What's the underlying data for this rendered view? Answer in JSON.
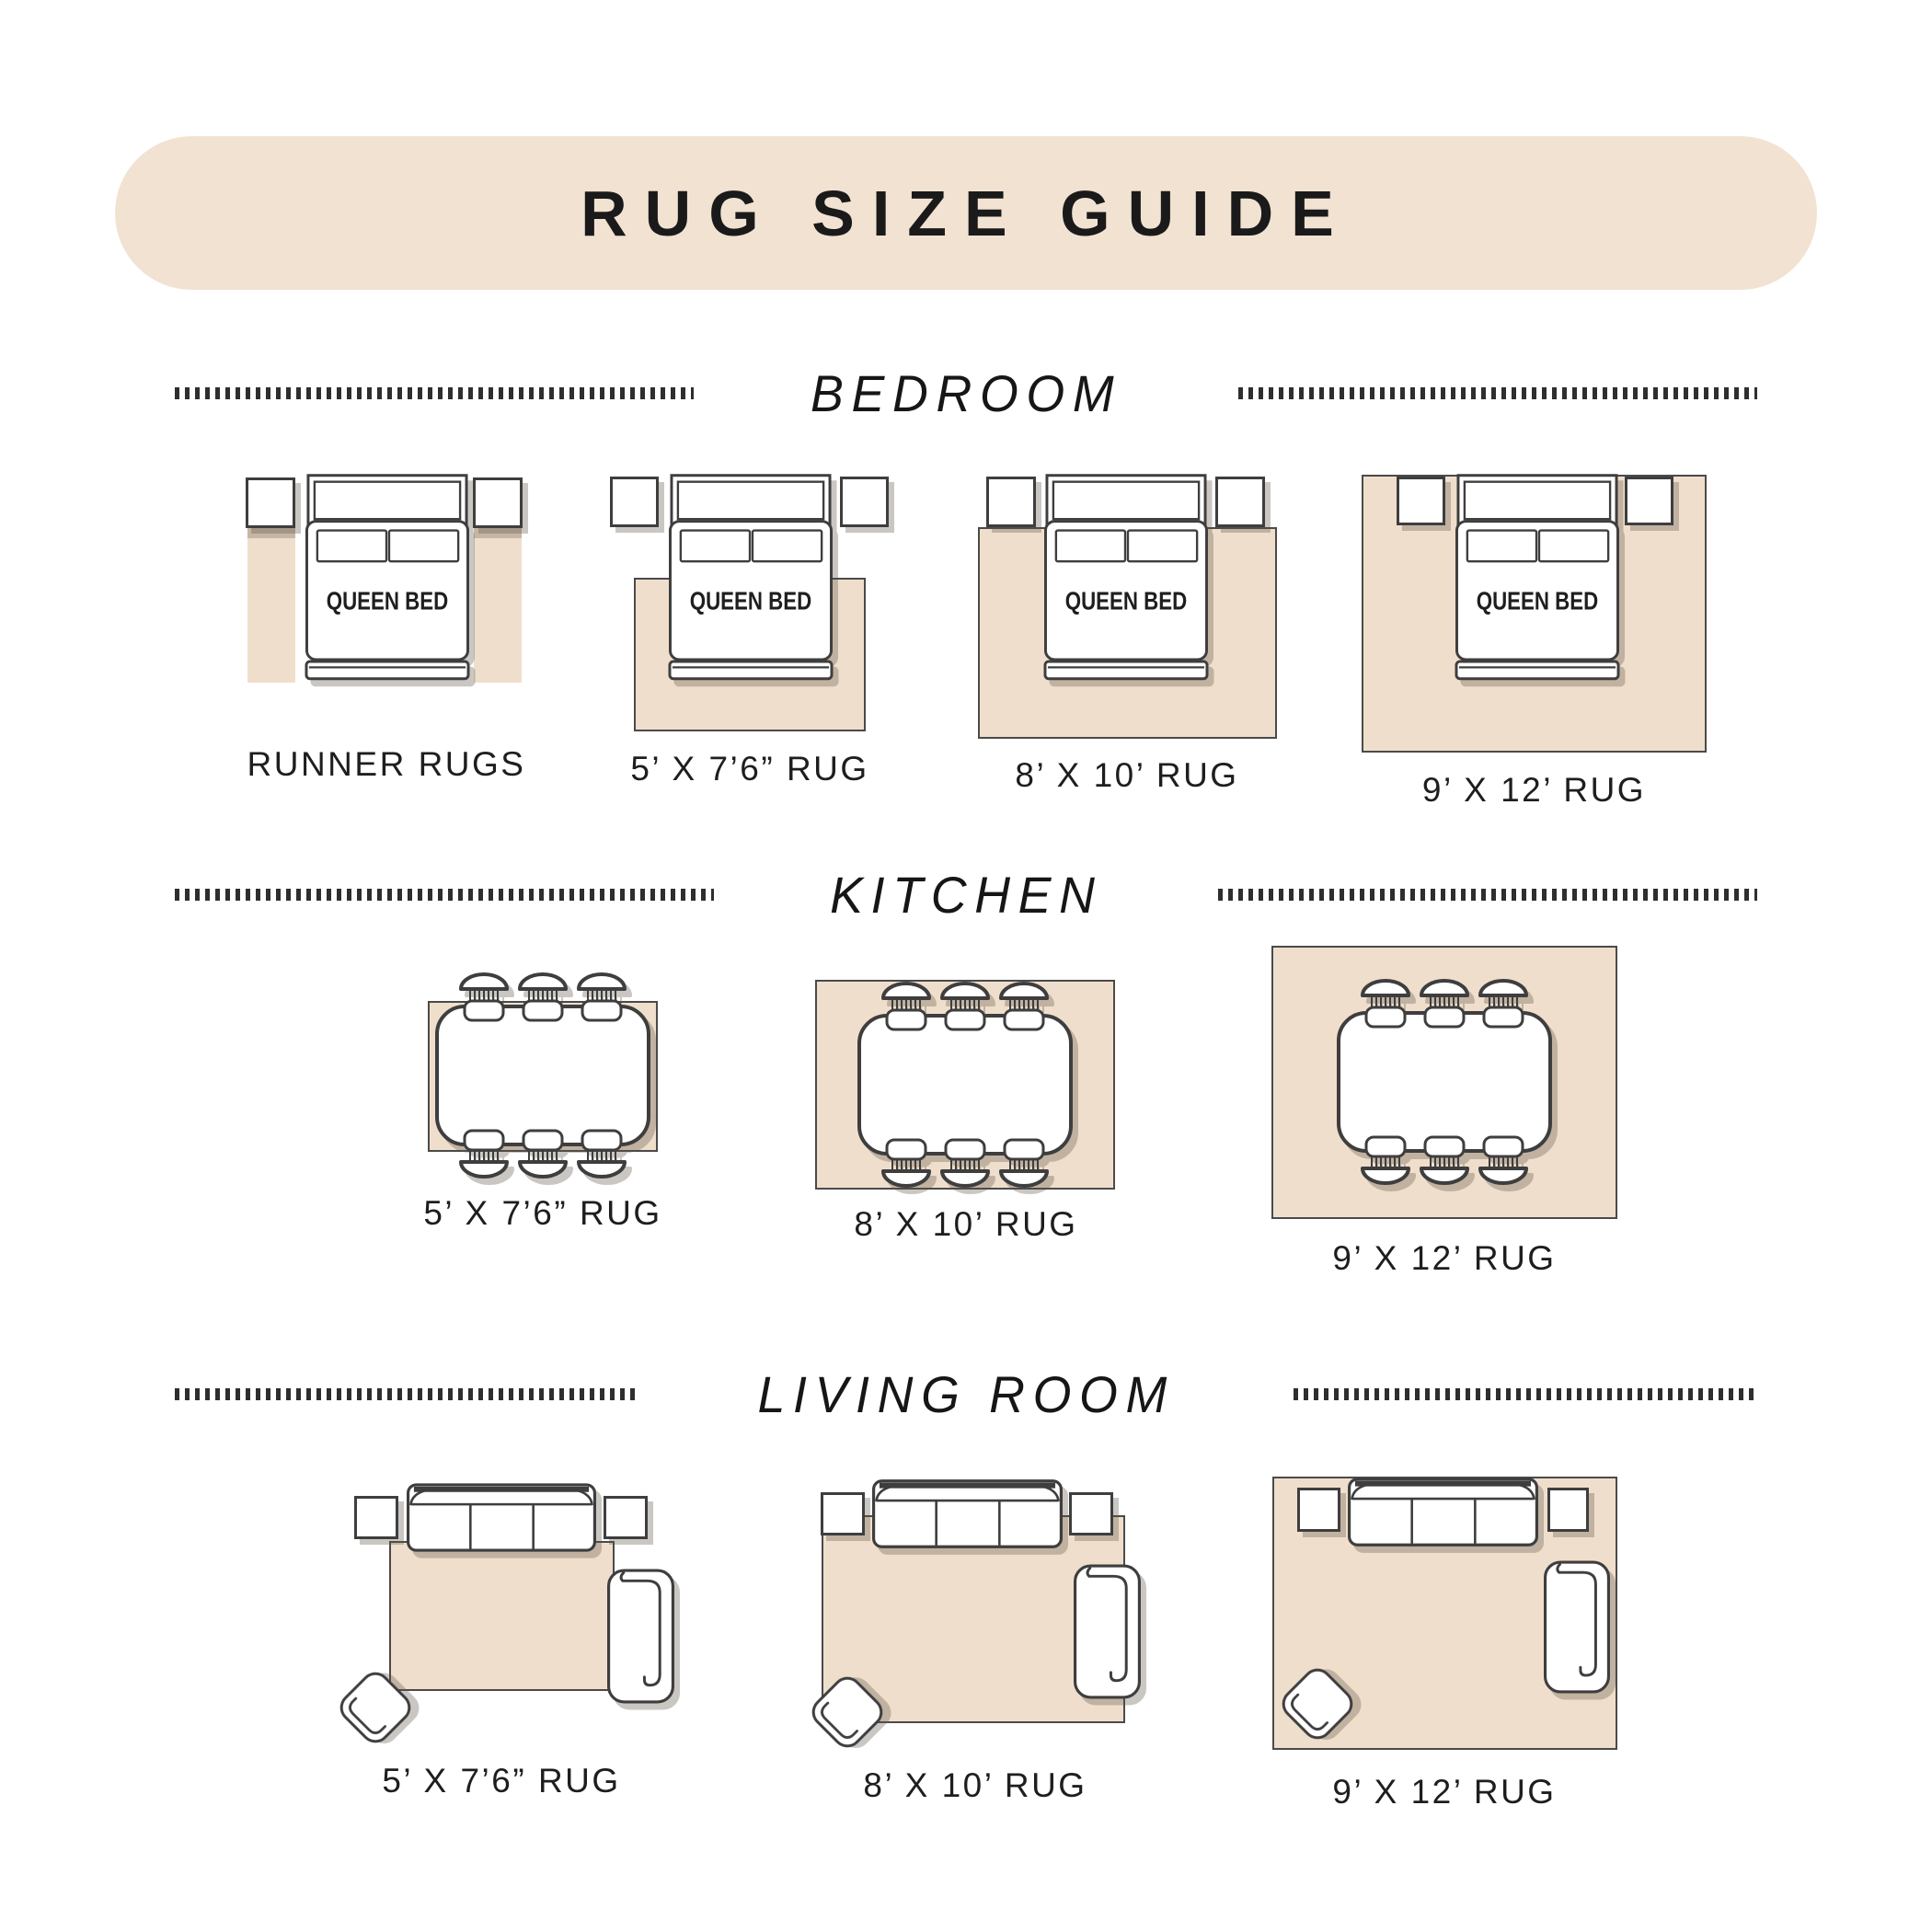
{
  "header": {
    "title": "RUG SIZE GUIDE"
  },
  "bed": {
    "label": "QUEEN BED"
  },
  "sections": [
    {
      "title": "BEDROOM",
      "items": [
        {
          "label": "RUNNER RUGS"
        },
        {
          "label": "5’ X 7’6” RUG"
        },
        {
          "label": "8’ X 10’ RUG"
        },
        {
          "label": "9’ X 12’ RUG"
        }
      ]
    },
    {
      "title": "KITCHEN",
      "items": [
        {
          "label": "5’ X 7’6” RUG"
        },
        {
          "label": "8’ X 10’ RUG"
        },
        {
          "label": "9’ X 12’ RUG"
        }
      ]
    },
    {
      "title": "LIVING ROOM",
      "items": [
        {
          "label": "5’ X 7’6” RUG"
        },
        {
          "label": "8’ X 10’ RUG"
        },
        {
          "label": "9’ X 12’ RUG"
        }
      ]
    }
  ],
  "colors": {
    "banner_bg": "#F2E2D2",
    "rug_fill": "#F0DECC",
    "outline": "#3E3E3E",
    "text": "#1E1E1E"
  }
}
